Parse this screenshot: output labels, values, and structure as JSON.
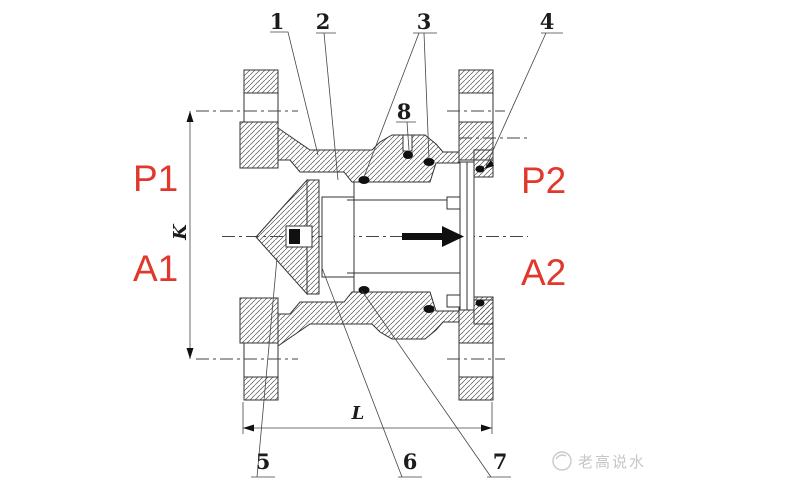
{
  "figure": {
    "type": "engineering-drawing",
    "subject": "Flanged check valve sectional drawing",
    "background_color": "#ffffff",
    "line_color": "#333333",
    "accent_red": "#e0382d",
    "watermark_gray": "#c6c6c6"
  },
  "callouts": {
    "c1": "1",
    "c2": "2",
    "c3": "3",
    "c4": "4",
    "c5": "5",
    "c6": "6",
    "c7": "7",
    "c8": "8"
  },
  "ports": {
    "p1": "P1",
    "a1": "A1",
    "p2": "P2",
    "a2": "A2"
  },
  "dimensions": {
    "bolt_circle": "K",
    "face_to_face": "L"
  },
  "flow": {
    "direction": "right",
    "icon": "flow-arrow-right"
  },
  "watermark": {
    "icon": "water-logo-icon",
    "text": "老高说水"
  }
}
